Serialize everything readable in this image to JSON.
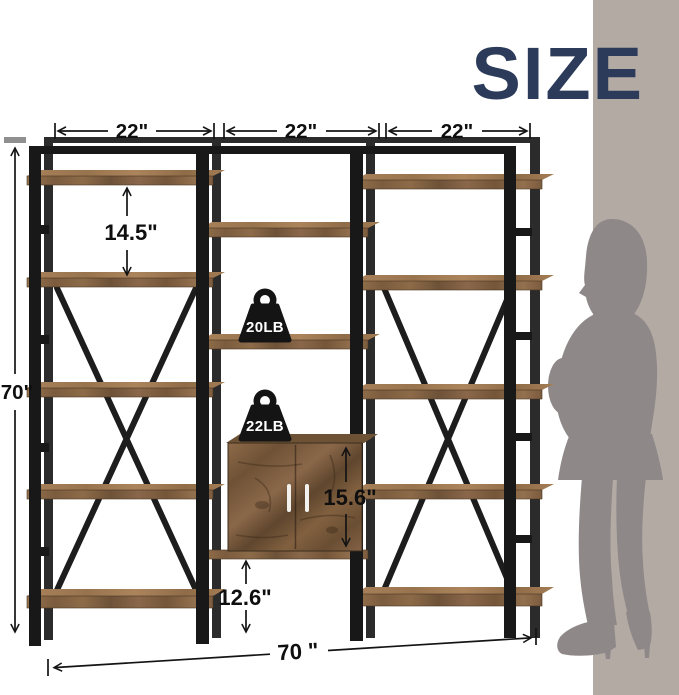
{
  "title": {
    "text": "SIZE",
    "color": "#2c3b5a"
  },
  "dimensions": {
    "section_widths": [
      "22\"",
      "22\"",
      "22\""
    ],
    "overall_height": "70\"",
    "shelf_spacing": "14.5\"",
    "cabinet_height": "15.6\"",
    "bottom_clearance": "12.6\"",
    "overall_width": "70 \""
  },
  "weights": {
    "open_shelf": "20LB",
    "cabinet_top": "22LB"
  },
  "scene": {
    "wall_band_color": "#b2aaa3",
    "silhouette_color": "#8e8889",
    "wood_color": "#8a6848",
    "metal_color": "#181818",
    "height_cap_color": "#8f8f8f"
  }
}
